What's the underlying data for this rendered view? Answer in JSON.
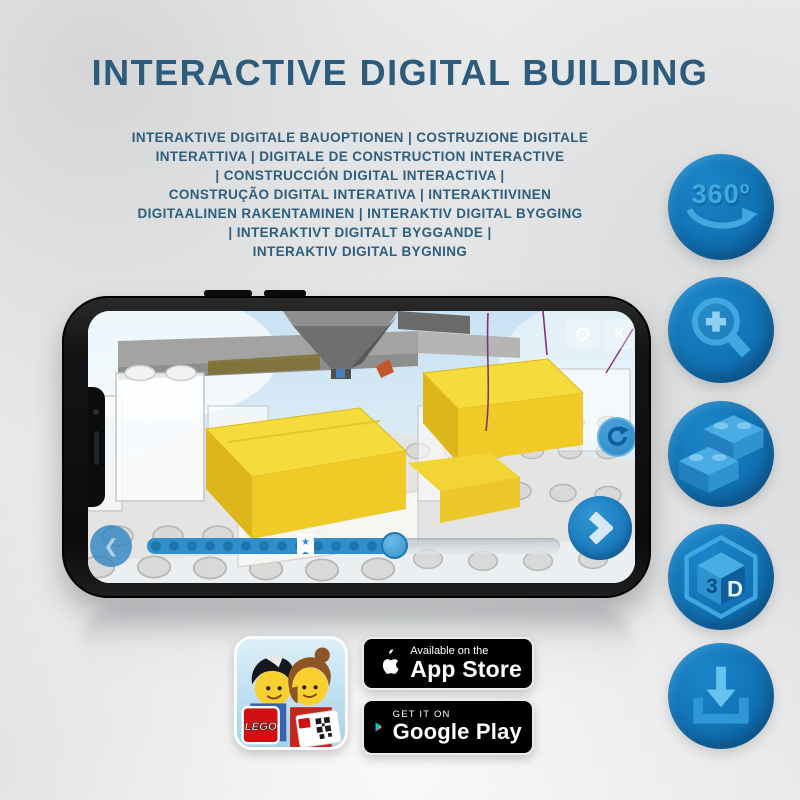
{
  "title": "INTERACTIVE DIGITAL BUILDING",
  "subtitle": {
    "lines": [
      "INTERAKTIVE DIGITALE BAUOPTIONEN | COSTRUZIONE DIGITALE",
      "INTERATTIVA | DIGITALE DE CONSTRUCTION INTERACTIVE",
      "| CONSTRUCCIÓN DIGITAL INTERACTIVA |",
      "CONSTRUÇÃO DIGITAL INTERATIVA | INTERAKTIIVINEN",
      "DIGITAALINEN RAKENTAMINEN | INTERAKTIV DIGITAL BYGGING",
      "| INTERAKTIVT DIGITALT BYGGANDE |",
      "INTERAKTIV DIGITAL BYGNING"
    ]
  },
  "features": {
    "rotate_label": "360º",
    "cube_left": "3",
    "cube_right": "D",
    "icon_names": [
      "360-rotation",
      "zoom-in",
      "bricks",
      "3d-view",
      "download"
    ]
  },
  "phone_ui": {
    "gear_glyph": "⚙",
    "close_glyph": "✕",
    "back_glyph": "❮",
    "star_glyph": "★",
    "slider": {
      "progress_percent": 60,
      "marker_percent": 38
    }
  },
  "badges": {
    "app_store_tagline": "Available on the",
    "app_store_name": "App Store",
    "google_play_tagline": "GET IT ON",
    "google_play_name": "Google Play",
    "lego_logo_text": "LEGO"
  },
  "colors": {
    "title_blue": "#2d5b7c",
    "feature_circle_blue": "#1173b6",
    "feature_glyph_blue": "#41a7e0",
    "ui_blue": "#2f8fca",
    "lego_yellow": "#f6db3d"
  }
}
